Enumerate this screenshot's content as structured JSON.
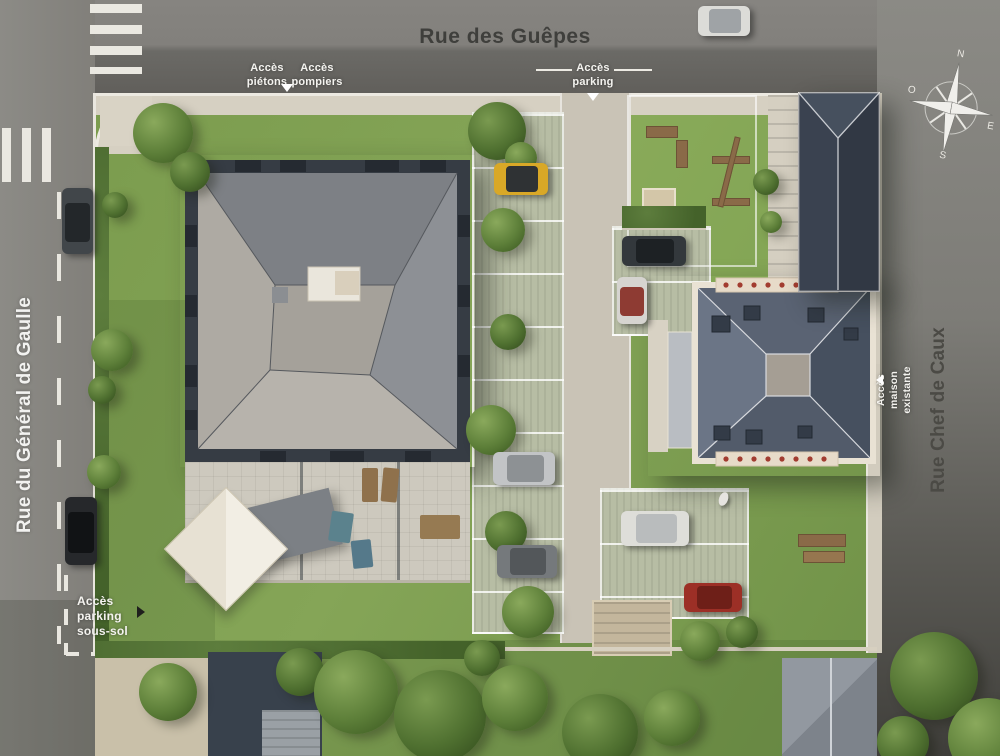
{
  "plan": {
    "type": "aerial residential site plan"
  },
  "streets": {
    "top": "Rue des Guêpes",
    "left": "Rue du Général de Gaulle",
    "right": "Rue Chef de Caux"
  },
  "access": {
    "pedestrians": "Accès piétons",
    "firefighters": "Accès pompiers",
    "parking": "Accès parking",
    "existing_house": "Accès maison existante",
    "basement_parking": "Accès parking sous-sol"
  },
  "compass": {
    "north": "N",
    "east": "E",
    "south": "S",
    "west": "O"
  },
  "palette": {
    "asphalt": "#807f7b",
    "asphalt_dark": "#5d5c58",
    "sidewalk": "#d6d0c2",
    "grass": "#7fa050",
    "grass_dark": "#5f7f3e",
    "roof_light": "#b3afa8",
    "roof_mid": "#84878c",
    "roof_dark": "#3d4450",
    "slate": "#556070",
    "driveway": "#c9c3b6",
    "paver": "#b7bda4",
    "marking_white": "#eceae3",
    "van_yellow": "#d9a827",
    "car_red": "#9c2f26"
  },
  "scene": {
    "trees": [
      [
        163,
        133,
        30,
        1
      ],
      [
        190,
        172,
        20,
        2
      ],
      [
        115,
        205,
        13,
        2
      ],
      [
        112,
        350,
        21,
        1
      ],
      [
        102,
        390,
        14,
        2
      ],
      [
        104,
        472,
        17,
        1
      ],
      [
        497,
        131,
        29,
        2
      ],
      [
        521,
        158,
        16,
        1
      ],
      [
        503,
        230,
        22,
        1
      ],
      [
        508,
        332,
        18,
        2
      ],
      [
        491,
        430,
        25,
        1
      ],
      [
        506,
        532,
        21,
        2
      ],
      [
        528,
        612,
        26,
        1
      ],
      [
        482,
        658,
        18,
        2
      ],
      [
        700,
        641,
        20,
        1
      ],
      [
        742,
        632,
        16,
        2
      ],
      [
        766,
        182,
        13,
        2
      ],
      [
        771,
        222,
        11,
        1
      ],
      [
        168,
        692,
        29,
        1
      ],
      [
        300,
        672,
        24,
        2
      ],
      [
        356,
        692,
        42,
        1
      ],
      [
        440,
        716,
        46,
        2
      ],
      [
        515,
        698,
        33,
        1
      ],
      [
        600,
        732,
        38,
        2
      ],
      [
        672,
        718,
        28,
        1
      ],
      [
        934,
        676,
        44,
        2
      ],
      [
        988,
        738,
        40,
        1
      ],
      [
        903,
        742,
        26,
        2
      ]
    ],
    "cars": [
      {
        "name": "car-street-top",
        "x": 698,
        "y": 6,
        "w": 52,
        "h": 30,
        "body": "#dcdcd8",
        "roof": "#9fa3a6"
      },
      {
        "name": "car-street-left-1",
        "x": 62,
        "y": 188,
        "w": 31,
        "h": 66,
        "body": "#41464a",
        "roof": "#23272a"
      },
      {
        "name": "car-street-left-2",
        "x": 65,
        "y": 497,
        "w": 32,
        "h": 68,
        "body": "#26282b",
        "roof": "#111315"
      },
      {
        "name": "van-parking-yellow",
        "x": 494,
        "y": 163,
        "w": 54,
        "h": 32,
        "body": "#d9a827",
        "roof": "#2f3234"
      },
      {
        "name": "car-parking-dark",
        "x": 622,
        "y": 236,
        "w": 64,
        "h": 30,
        "body": "#33383c",
        "roof": "#1d2124"
      },
      {
        "name": "car-parking-redroof",
        "x": 617,
        "y": 277,
        "w": 30,
        "h": 47,
        "body": "#d6d4d0",
        "roof": "#8e3b33"
      },
      {
        "name": "car-parking-silver",
        "x": 493,
        "y": 452,
        "w": 62,
        "h": 33,
        "body": "#c2c4c6",
        "roof": "#8d9194"
      },
      {
        "name": "car-parking-gray",
        "x": 497,
        "y": 545,
        "w": 60,
        "h": 33,
        "body": "#75797c",
        "roof": "#53575a"
      },
      {
        "name": "car-parking-white",
        "x": 621,
        "y": 511,
        "w": 68,
        "h": 35,
        "body": "#deded9",
        "roof": "#b9bcbd"
      },
      {
        "name": "car-parking-red",
        "x": 684,
        "y": 583,
        "w": 58,
        "h": 29,
        "body": "#9c2f26",
        "roof": "#6e1f18"
      }
    ]
  }
}
